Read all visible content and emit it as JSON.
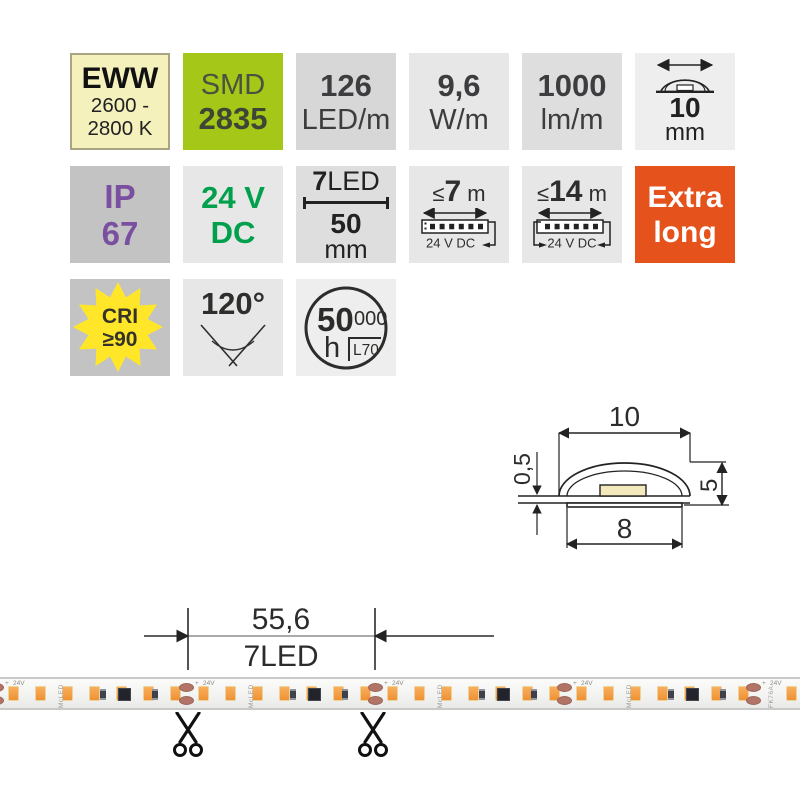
{
  "badges": {
    "cct": {
      "line1": "EWW",
      "line2": "2600 -",
      "line3": "2800 K"
    },
    "smd": {
      "line1": "SMD",
      "line2": "2835"
    },
    "density": {
      "value": "126",
      "unit": "LED/m"
    },
    "power": {
      "value": "9,6",
      "unit": "W/m"
    },
    "flux": {
      "value": "1000",
      "unit": "lm/m"
    },
    "width": {
      "value": "10",
      "unit": "mm"
    },
    "ip": {
      "line1": "IP",
      "line2": "67"
    },
    "voltage": {
      "line1": "24 V",
      "line2": "DC"
    },
    "cut": {
      "count": "7",
      "count_unit": "LED",
      "length": "50",
      "length_unit": "mm"
    },
    "run7": {
      "prefix": "≤",
      "value": "7",
      "unit": " m",
      "sub": "24 V DC"
    },
    "run14": {
      "prefix": "≤",
      "value": "14",
      "unit": " m",
      "sub": "24 V DC"
    },
    "extra": {
      "line1": "Extra",
      "line2": "long"
    },
    "cri": {
      "line1": "CRI",
      "line2": "≥90"
    },
    "angle": {
      "value": "120°"
    },
    "lifetime": {
      "big": "50",
      "small": "000",
      "hours": "h",
      "l70": "L70"
    }
  },
  "diagram": {
    "width_top": "10",
    "thickness": "0,5",
    "height": "5",
    "width_bottom": "8"
  },
  "strip": {
    "dim_value": "55,6",
    "dim_label": "7LED",
    "voltage_label": "24V",
    "plus": "+",
    "brand": "McLED",
    "part_label": "FK76A",
    "cut_positions": [
      -4,
      186,
      375,
      564,
      753
    ],
    "leds_per_segment": 7
  },
  "colors": {
    "accent_green": "#a5c717",
    "accent_orange": "#e5521c",
    "ip_purple": "#7b4fa0",
    "dc_green": "#00a04c",
    "star_yellow": "#ffe629",
    "cct_yellow": "#f4f1bd",
    "led_orange": "#f5a04a",
    "pad_copper": "#b27467"
  }
}
